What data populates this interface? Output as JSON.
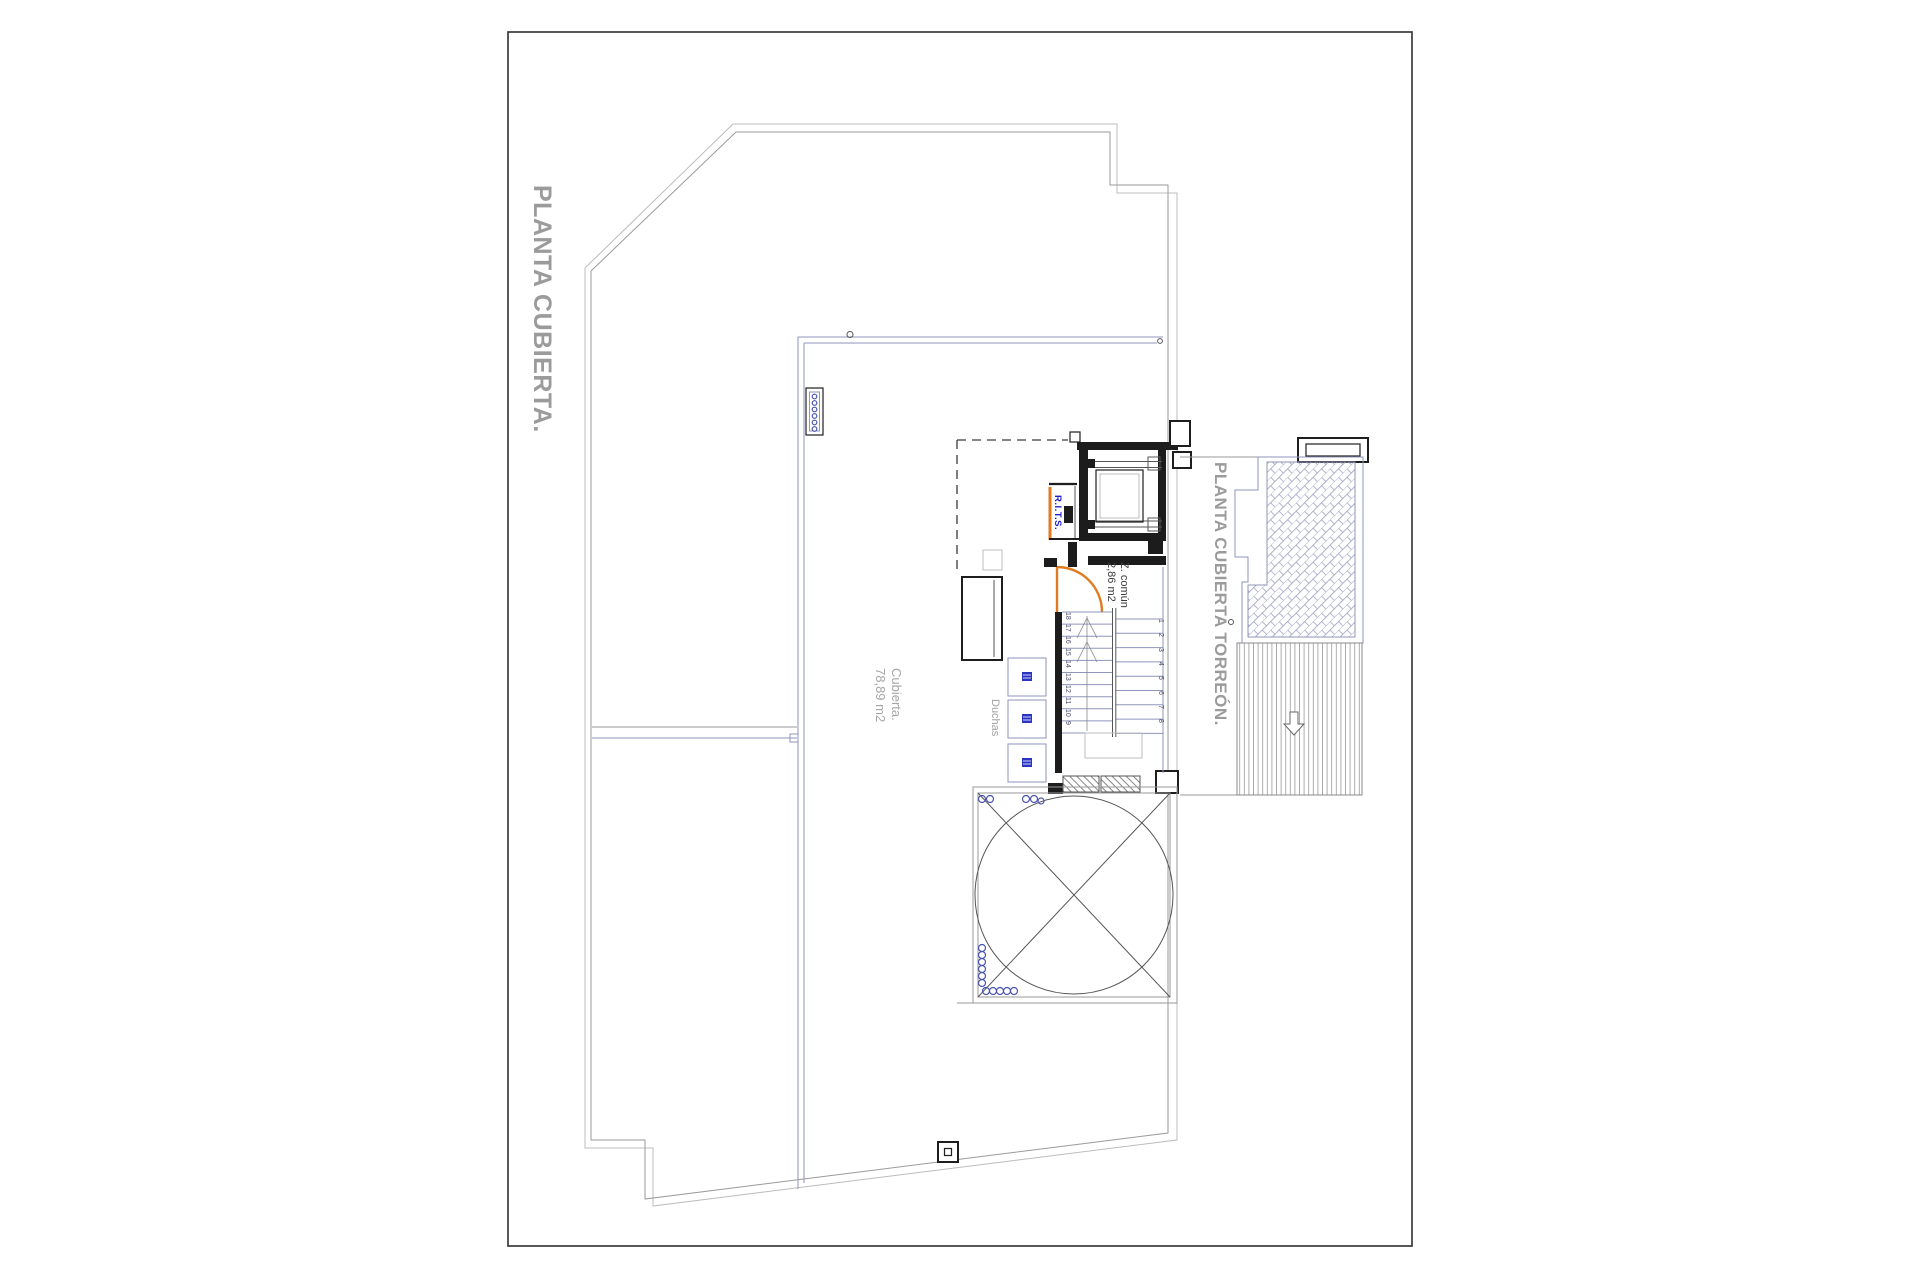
{
  "page": {
    "title": "PLANTA CUBIERTA.",
    "torreon_title": "PLANTA CUBIERTA TORREÓN."
  },
  "labels": {
    "cubierta_name": "Cubierta.",
    "cubierta_area": "78,89 m2",
    "duchas": "Duchas",
    "z_comun_name": "Z. común",
    "z_comun_area": "2,86 m2",
    "rits": "R.I.T.S."
  },
  "stairs": {
    "left_numbers": [
      "18",
      "17",
      "16",
      "15",
      "14",
      "13",
      "12",
      "11",
      "10",
      "9"
    ],
    "right_numbers": [
      "1",
      "2",
      "3",
      "4",
      "5",
      "6",
      "7",
      "8"
    ]
  },
  "colors": {
    "accent_orange": "#e07b20",
    "rits_blue": "#2020c8",
    "label_gray": "#9b9b9b",
    "line_gray": "#9a9a9a",
    "plate_blue": "#8f95bb",
    "wall_black": "#1c1c1c",
    "marker_blue": "#4a55b0"
  }
}
